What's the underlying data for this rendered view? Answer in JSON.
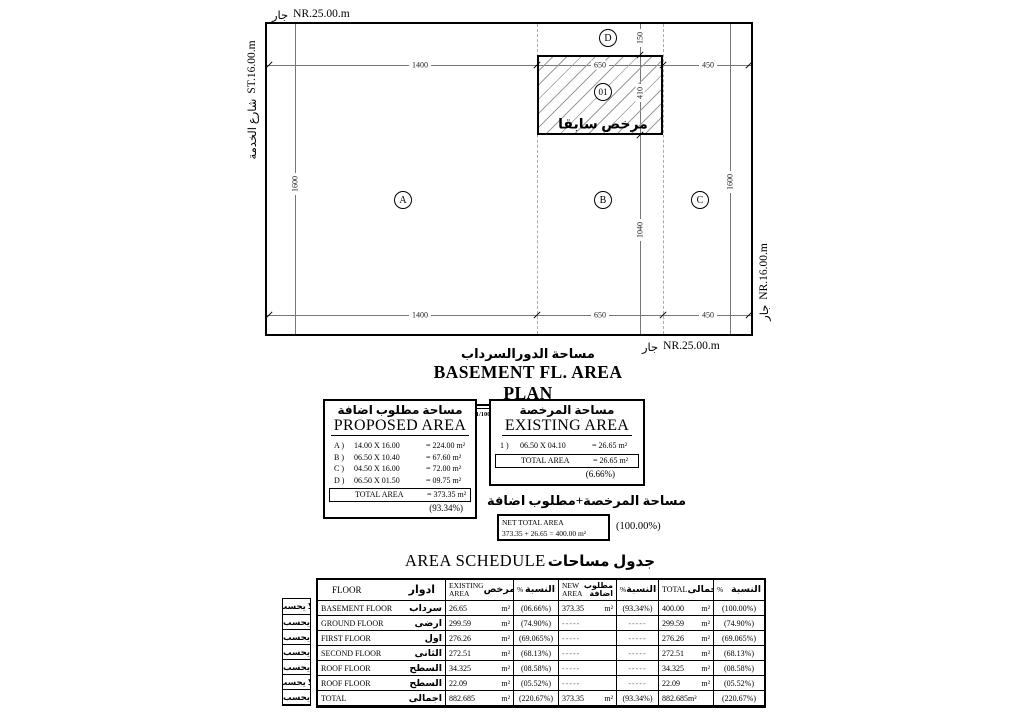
{
  "plan": {
    "top_boundary_ar": "جار",
    "top_boundary_en": "NR.25.00.m",
    "left_street_ar": "شارع الخدمة",
    "left_street_en": "ST.16.00.m",
    "right_boundary_ar": "جار",
    "right_boundary_en": "NR.16.00.m",
    "bottom_boundary_ar": "جار",
    "bottom_boundary_en": "NR.25.00.m",
    "zones": [
      "A",
      "B",
      "C",
      "D"
    ],
    "hatch_number": "01",
    "hatch_text": "مرخص سابقا",
    "dims_top": [
      "1400",
      "650",
      "450"
    ],
    "dims_bottom": [
      "1400",
      "650",
      "450"
    ],
    "dim_left": "1600",
    "dim_right": "1600",
    "dims_mid": [
      "150",
      "410",
      "1040"
    ]
  },
  "title_block": {
    "title_ar": "مساحة الدورالسرداب",
    "title_en": "BASEMENT FL. AREA PLAN",
    "scale_label": "SCALE",
    "scale_value": "1/100"
  },
  "proposed_area": {
    "title_ar": "مساحة مطلوب اضافة",
    "title_en": "PROPOSED AREA",
    "items": [
      {
        "id": "A )",
        "dims": "14.00 X 16.00",
        "result": "= 224.00 m²"
      },
      {
        "id": "B )",
        "dims": "06.50 X 10.40",
        "result": "= 67.60  m²"
      },
      {
        "id": "C )",
        "dims": "04.50 X 16.00",
        "result": "= 72.00  m²"
      },
      {
        "id": "D )",
        "dims": "06.50 X 01.50",
        "result": "= 09.75  m²"
      }
    ],
    "total_label": "TOTAL AREA",
    "total_value": "= 373.35 m²",
    "percent": "(93.34%)"
  },
  "existing_area": {
    "title_ar": "مساحة المرخصة",
    "title_en": "EXISTING AREA",
    "items": [
      {
        "id": "1 )",
        "dims": "06.50 X 04.10",
        "result": "= 26.65 m²"
      }
    ],
    "total_label": "TOTAL AREA",
    "total_value": "= 26.65 m²",
    "percent": "(6.66%)"
  },
  "net_total": {
    "caption_ar": "مساحة المرخصة+مطلوب اضافة",
    "label": "NET TOTAL AREA",
    "equation": "373.35 + 26.65  = 400.00 m²",
    "percent": "(100.00%)"
  },
  "schedule": {
    "title_en": "AREA SCHEDULE",
    "title_ar": "جدول مساحات",
    "headers": {
      "floor_en": "FLOOR",
      "floor_ar": "ادوار",
      "existing_l1": "EXISTING",
      "existing_l2": "AREA",
      "existing_ar": "مرخص",
      "pct_sym": "%",
      "pct_ar": "النسبة",
      "new_l1": "NEW",
      "new_l2": "AREA",
      "new_ar_l1": "مطلوب",
      "new_ar_l2": "اضافة",
      "total_en": "TOTAL",
      "total_ar": "اجمالى"
    },
    "rows": [
      {
        "flag": "لا يحسب",
        "floor_en": "BASEMENT FLOOR",
        "floor_ar": "سرداب",
        "existing": "26.65",
        "existing_u": "m²",
        "existing_pct": "(06.66%)",
        "new": "373.35",
        "new_u": "m²",
        "new_pct": "(93.34%)",
        "total": "400.00",
        "total_u": "m²",
        "total_pct": "(100.00%)"
      },
      {
        "flag": "يحسب",
        "floor_en": "GROUND FLOOR",
        "floor_ar": "ارضى",
        "existing": "299.59",
        "existing_u": "m²",
        "existing_pct": "(74.90%)",
        "new": "-----",
        "new_u": "",
        "new_pct": "-----",
        "total": "299.59",
        "total_u": "m²",
        "total_pct": "(74.90%)"
      },
      {
        "flag": "يحسب",
        "floor_en": "FIRST FLOOR",
        "floor_ar": "اول",
        "existing": "276.26",
        "existing_u": "m²",
        "existing_pct": "(69.065%)",
        "new": "-----",
        "new_u": "",
        "new_pct": "-----",
        "total": "276.26",
        "total_u": "m²",
        "total_pct": "(69.065%)"
      },
      {
        "flag": "يحسب",
        "floor_en": "SECOND FLOOR",
        "floor_ar": "الثانى",
        "existing": "272.51",
        "existing_u": "m²",
        "existing_pct": "(68.13%)",
        "new": "-----",
        "new_u": "",
        "new_pct": "-----",
        "total": "272.51",
        "total_u": "m²",
        "total_pct": "(68.13%)"
      },
      {
        "flag": "يحسب",
        "floor_en": "ROOF FLOOR",
        "floor_ar": "السطح",
        "existing": "34.325",
        "existing_u": "m²",
        "existing_pct": "(08.58%)",
        "new": "-----",
        "new_u": "",
        "new_pct": "-----",
        "total": "34.325",
        "total_u": "m²",
        "total_pct": "(08.58%)"
      },
      {
        "flag": "لا يحسب",
        "floor_en": "ROOF FLOOR",
        "floor_ar": "السطح",
        "existing": "22.09",
        "existing_u": "m²",
        "existing_pct": "(05.52%)",
        "new": "-----",
        "new_u": "",
        "new_pct": "-----",
        "total": "22.09",
        "total_u": "m²",
        "total_pct": "(05.52%)"
      },
      {
        "flag": "يحسب",
        "floor_en": "TOTAL",
        "floor_ar": "اجمالى",
        "existing": "882.685",
        "existing_u": "m²",
        "existing_pct": "(220.67%)",
        "new": "373.35",
        "new_u": "m²",
        "new_pct": "(93.34%)",
        "total": "882.685m²",
        "total_u": "",
        "total_pct": "(220.67%)"
      }
    ]
  }
}
